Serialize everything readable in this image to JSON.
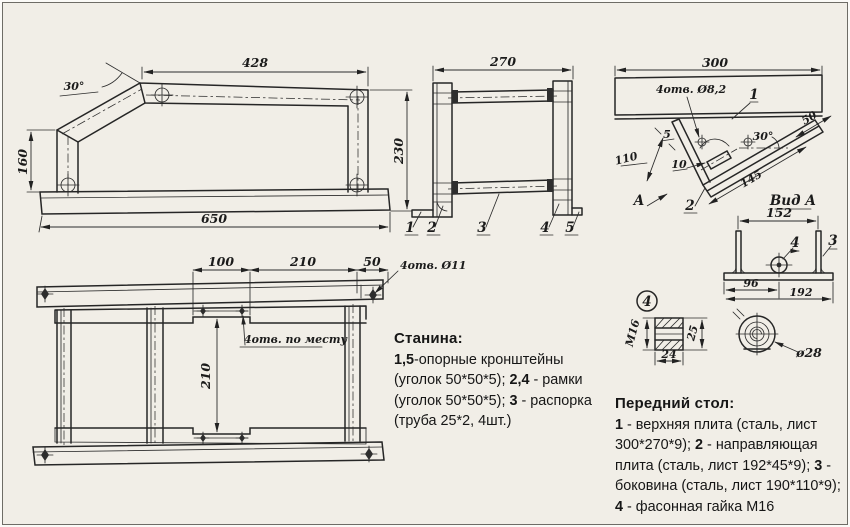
{
  "frame_side": {
    "dim_top": "428",
    "angle": "30°",
    "dim_left": "160",
    "dim_right": "230",
    "dim_bottom": "650"
  },
  "frame_front": {
    "dim_top": "270",
    "part1": "1",
    "part2": "2",
    "part3": "3",
    "part4": "4",
    "part5": "5"
  },
  "table_side": {
    "dim_top": "300",
    "holes_label": "4отв. Ø8,2",
    "part1": "1",
    "angle": "30°",
    "dim_width": "110",
    "dim_5": "5",
    "dim_10": "10",
    "dim_145": "145",
    "dim_50": "50",
    "part2": "2",
    "view_arrow": "А"
  },
  "view_a": {
    "title": "Вид А",
    "dim_top": "152",
    "part4": "4",
    "part3": "3",
    "dim_96": "96",
    "dim_192": "192"
  },
  "stand_top": {
    "dim_100": "100",
    "dim_210": "210",
    "dim_50": "50",
    "holes_11": "4отв. Ø11",
    "holes_place": "4отв. по месту",
    "dim_height": "210"
  },
  "nut": {
    "badge": "4",
    "thread": "М16",
    "dim_25": "25",
    "dim_24": "24",
    "dia": "ø28"
  },
  "notes": {
    "stanina": {
      "title": "Станина:",
      "segments": [
        [
          "b",
          "1,5"
        ],
        [
          "t",
          "-опорные кронштейны"
        ],
        [
          "br"
        ],
        [
          "t",
          "(уголок 50*50*5); "
        ],
        [
          "b",
          "2,4"
        ],
        [
          "t",
          " - рамки"
        ],
        [
          "br"
        ],
        [
          "t",
          "(уголок 50*50*5); "
        ],
        [
          "b",
          "3"
        ],
        [
          "t",
          " - распорка"
        ],
        [
          "br"
        ],
        [
          "t",
          "(труба 25*2, 4шт.)"
        ]
      ]
    },
    "table": {
      "title": "Передний стол:",
      "segments": [
        [
          "b",
          "1"
        ],
        [
          "t",
          " - верхняя плита (сталь, лист"
        ],
        [
          "br"
        ],
        [
          "t",
          "300*270*9); "
        ],
        [
          "b",
          "2"
        ],
        [
          "t",
          " - направляющая"
        ],
        [
          "br"
        ],
        [
          "t",
          "плита (сталь, лист 192*45*9); "
        ],
        [
          "b",
          "3"
        ],
        [
          "t",
          " -"
        ],
        [
          "br"
        ],
        [
          "t",
          "боковина (сталь, лист 190*110*9);"
        ],
        [
          "br"
        ],
        [
          "b",
          "4"
        ],
        [
          "t",
          " - фасонная гайка М16"
        ]
      ]
    }
  }
}
